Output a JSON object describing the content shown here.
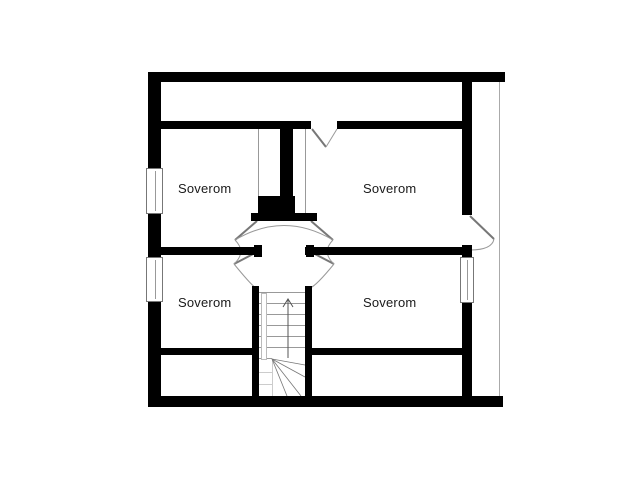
{
  "plan": {
    "rooms": [
      {
        "label": "Soverom",
        "position": "top-left"
      },
      {
        "label": "Soverom",
        "position": "top-right"
      },
      {
        "label": "Soverom",
        "position": "bottom-left"
      },
      {
        "label": "Soverom",
        "position": "bottom-right"
      }
    ],
    "colors": {
      "background": "#ffffff",
      "wall": "#000000",
      "thin_line": "#999999",
      "door_line": "#777777",
      "light_line": "#cccccc",
      "text": "#1a1a1a"
    }
  }
}
